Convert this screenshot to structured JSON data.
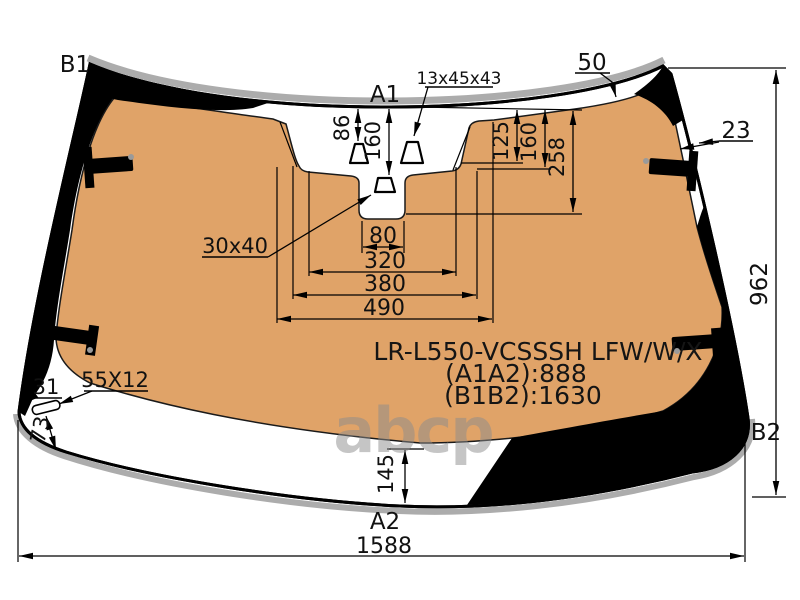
{
  "diagram": {
    "part_text": {
      "line1": "LR-L550-VCSSSH LFW/W/X",
      "line2": "(A1A2):888",
      "line3": "(B1B2):1630"
    },
    "markers": {
      "b1": "B1",
      "a1": "A1",
      "b2": "B2",
      "a2": "A2"
    },
    "dims": {
      "top_edge_offset": "50",
      "edge_band": "23",
      "height_right": "962",
      "width_bottom": "1588",
      "bottom_band": "145",
      "sensor_offset": "86",
      "mirror_offset": "160",
      "cam_step1": "125",
      "cam_step2": "160",
      "cam_step3": "258",
      "slot_width": "80",
      "width_320": "320",
      "width_380": "380",
      "width_490": "490",
      "corner_gap": "31",
      "bracket_size": "55X12",
      "corner_height": "73",
      "mirror_size": "30x40",
      "sensor_size": "13x45x43"
    },
    "watermark": "abcp",
    "colors": {
      "glass_tint": "#E0A368",
      "frit": "#000000",
      "molding": "#ACACAC",
      "background": "#FFFFFF",
      "watermark": "#8C8C8C"
    }
  }
}
